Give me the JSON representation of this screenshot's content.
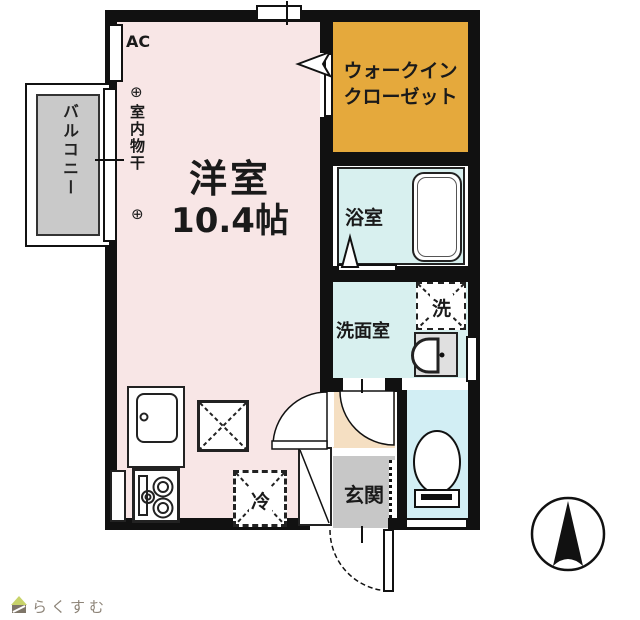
{
  "plan": {
    "main_room": {
      "name": "洋室",
      "size": "10.4帖"
    },
    "ac_label": "AC",
    "indoor_drying": {
      "mark_top": "⊕",
      "label": "室内物干",
      "mark_bottom": "⊕"
    },
    "walk_in_closet": {
      "line1": "ウォークイン",
      "line2": "クローゼット"
    },
    "bathroom_label": "浴室",
    "washer_label": "洗",
    "washroom_label": "洗面室",
    "entrance_label": "玄関",
    "fridge_label": "冷",
    "balcony_label": "バルコニー"
  },
  "colors": {
    "wall_black": "#111111",
    "room_pink": "#F8E6E6",
    "wic_orange": "#E5A93C",
    "wet_cyan": "#D8F0EF",
    "toilet_cyan": "#D2EEF4",
    "hall_peach": "#F5DFC2",
    "entrance_gray": "#C7C7C7",
    "balcony_gray": "#C9C9C9",
    "logo_green": "#C8D36A",
    "logo_brown": "#7E7568",
    "logo_text_color": "#8D8478"
  },
  "footer": {
    "logo_text": "らくすむ"
  }
}
